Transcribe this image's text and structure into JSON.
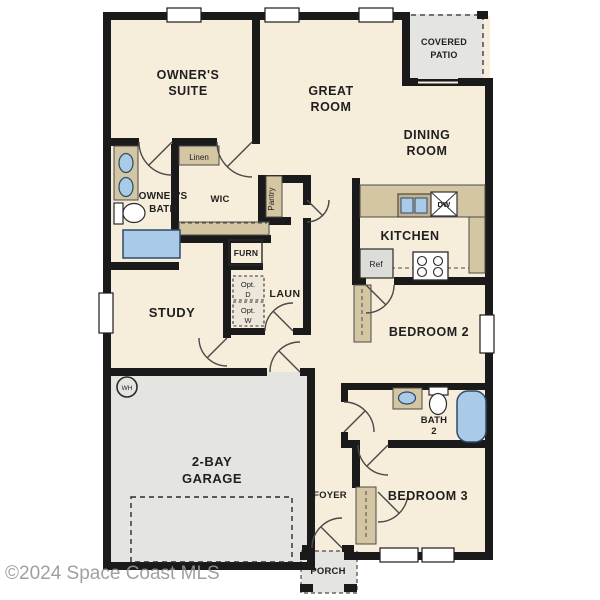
{
  "title": "Single-story residential floor plan",
  "watermark": "©2024 Space Coast MLS",
  "colors": {
    "floor": "#f7eddb",
    "garage_floor": "#e4e4e0",
    "wall": "#1a1a1a",
    "counter_tan": "#d4c5a3",
    "fixture_blue": "#a9cbe8",
    "watermark_gray": "#969696"
  },
  "rooms": {
    "owners_suite": {
      "line1": "OWNER'S",
      "line2": "SUITE"
    },
    "great_room": {
      "line1": "GREAT",
      "line2": "ROOM"
    },
    "dining_room": {
      "line1": "DINING",
      "line2": "ROOM"
    },
    "covered_patio": {
      "line1": "COVERED",
      "line2": "PATIO"
    },
    "kitchen": {
      "label": "KITCHEN"
    },
    "owners_bath": {
      "line1": "OWNER'S",
      "line2": "BATH"
    },
    "wic": {
      "label": "WIC"
    },
    "linen": {
      "label": "Linen"
    },
    "pantry": {
      "label": "Pantry"
    },
    "furnace": {
      "label": "FURN"
    },
    "laundry": {
      "label": "LAUN"
    },
    "opt_dryer": {
      "line1": "Opt.",
      "line2": "D"
    },
    "opt_washer": {
      "line1": "Opt.",
      "line2": "W"
    },
    "study": {
      "label": "STUDY"
    },
    "bedroom2": {
      "label": "BEDROOM 2"
    },
    "bath2": {
      "line1": "BATH",
      "line2": "2"
    },
    "bedroom3": {
      "label": "BEDROOM 3"
    },
    "foyer": {
      "label": "FOYER"
    },
    "garage": {
      "line1": "2-BAY",
      "line2": "GARAGE"
    },
    "porch": {
      "label": "PORCH"
    }
  },
  "fixtures": {
    "refrigerator": "Ref",
    "dishwasher": "DW",
    "water_heater": "WH"
  }
}
